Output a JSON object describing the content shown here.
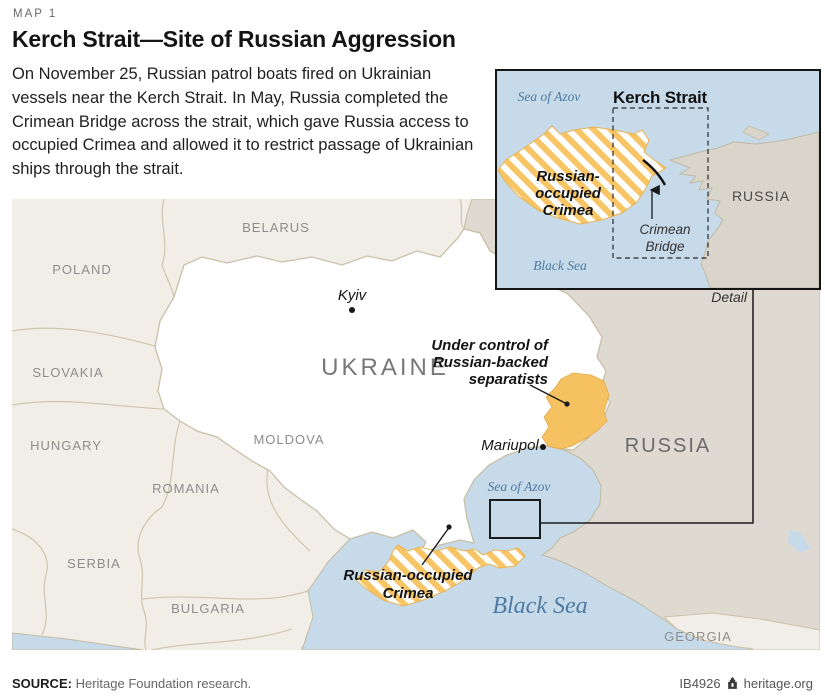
{
  "header": {
    "kicker": "MAP 1",
    "title": "Kerch Strait—Site of Russian Aggression",
    "description": "On November 25, Russian patrol boats fired on Ukrainian vessels near the Kerch Strait. In May, Russia completed the Crimean Bridge across the strait, which gave Russia access to occupied Crimea and allowed it to restrict passage of Ukrainian ships through the strait."
  },
  "inset": {
    "title": "Kerch Strait",
    "sea_of_azov": "Sea of Azov",
    "black_sea": "Black Sea",
    "russia": "RUSSIA",
    "crimea_lines": [
      "Russian-",
      "occupied",
      "Crimea"
    ],
    "bridge_lines": [
      "Crimean",
      "Bridge"
    ],
    "detail_label": "Detail"
  },
  "map": {
    "countries": {
      "poland": "POLAND",
      "belarus": "BELARUS",
      "slovakia": "SLOVAKIA",
      "hungary": "HUNGARY",
      "moldova": "MOLDOVA",
      "romania": "ROMANIA",
      "serbia": "SERBIA",
      "bulgaria": "BULGARIA",
      "ukraine": "UKRAINE",
      "russia": "RUSSIA",
      "georgia": "GEORGIA"
    },
    "cities": {
      "kyiv": "Kyiv",
      "mariupol": "Mariupol"
    },
    "seas": {
      "azov": "Sea of Azov",
      "black": "Black Sea"
    },
    "annotations": {
      "separatists_lines": [
        "Under control of",
        "Russian-backed",
        "separatists"
      ],
      "crimea_lines": [
        "Russian-occupied",
        "Crimea"
      ]
    }
  },
  "footer": {
    "source_label": "SOURCE:",
    "source_text": "Heritage Foundation research.",
    "doc_id": "IB4926",
    "site": "heritage.org"
  },
  "colors": {
    "sea": "#c7daea",
    "neutral_land": "#f1eee7",
    "russia_land": "#dedad2",
    "ukraine_land": "#ffffff",
    "occupied_orange": "#f8c566",
    "border_line": "#cbc2a9",
    "sea_label_blue": "#4d7ba3",
    "connector_black": "#1a1a1a"
  }
}
